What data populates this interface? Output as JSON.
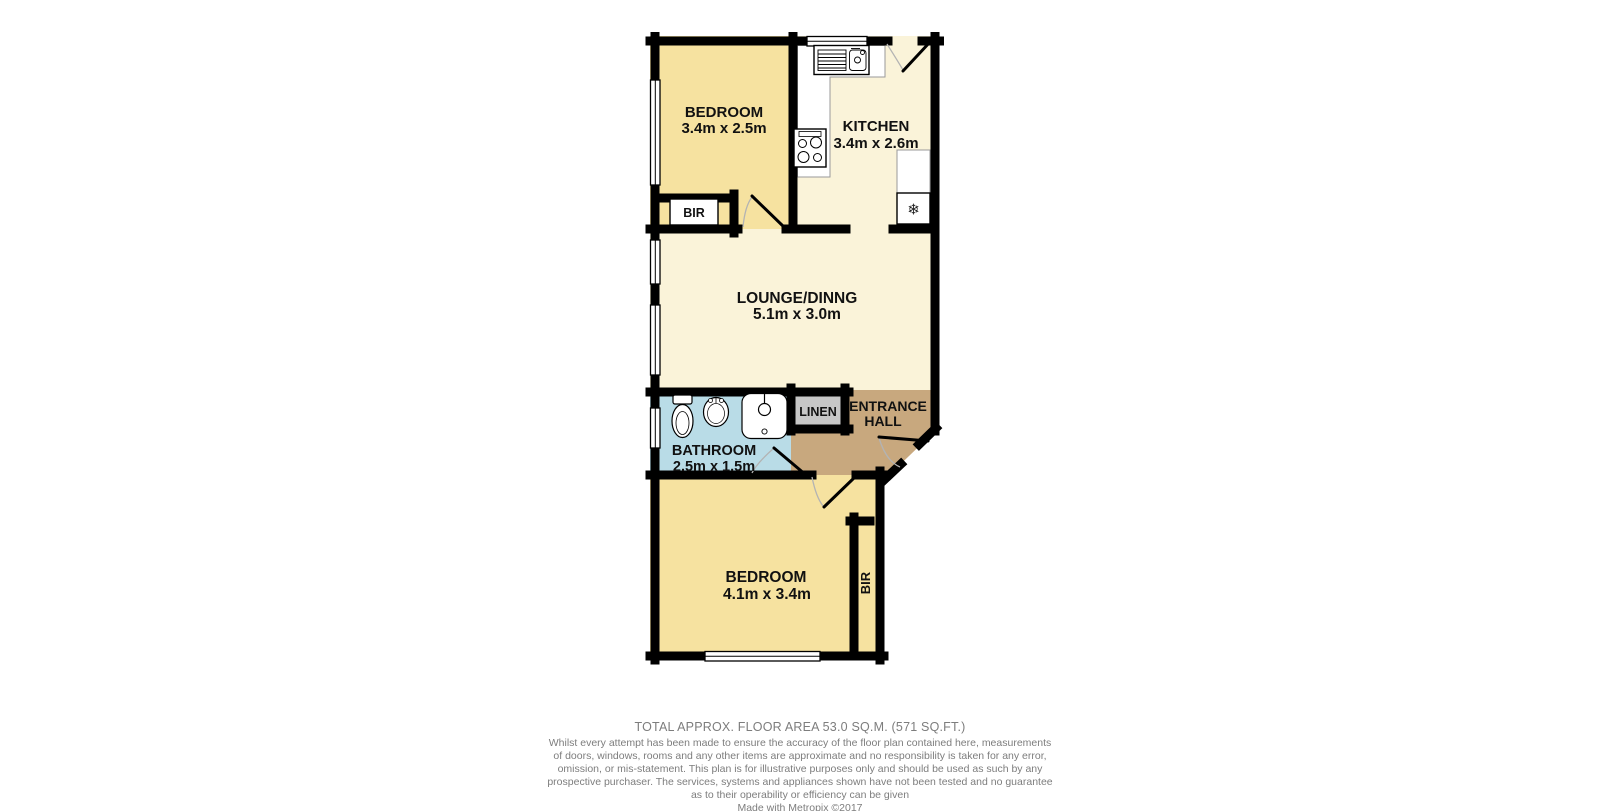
{
  "plan": {
    "bedroom_top": {
      "name": "BEDROOM",
      "dims": "3.4m x 2.5m"
    },
    "kitchen": {
      "name": "KITCHEN",
      "dims": "3.4m x 2.6m"
    },
    "lounge": {
      "name": "LOUNGE/DINNG",
      "dims": "5.1m x 3.0m"
    },
    "bathroom": {
      "name": "BATHROOM",
      "dims": "2.5m x 1.5m"
    },
    "linen": {
      "name": "LINEN"
    },
    "entrance_hall": {
      "line1": "ENTRANCE",
      "line2": "HALL"
    },
    "bedroom_bottom": {
      "name": "BEDROOM",
      "dims": "4.1m x 3.4m"
    },
    "bir_top": "BIR",
    "bir_bottom": "BIR",
    "fridge_glyph": "❄",
    "colors": {
      "bedroom": "#f6e2a0",
      "living": "#faf3d9",
      "bathroom": "#b9dce7",
      "linen": "#c7c7c7",
      "hall": "#c8a87e",
      "wall": "#000000"
    }
  },
  "footer": {
    "total_area": "TOTAL APPROX. FLOOR AREA 53.0 SQ.M. (571 SQ.FT.)",
    "disclaimer_lines": [
      "Whilst every attempt has been made to ensure the accuracy of the floor plan contained here, measurements",
      "of doors, windows, rooms and any other items are approximate and no responsibility is taken for any error,",
      "omission, or mis-statement. This plan is for illustrative purposes only and should be used as such by any",
      "prospective purchaser. The services, systems and appliances shown have not been tested and no guarantee",
      "as to their operability or efficiency can be given"
    ],
    "credit": "Made with Metropix ©2017"
  }
}
